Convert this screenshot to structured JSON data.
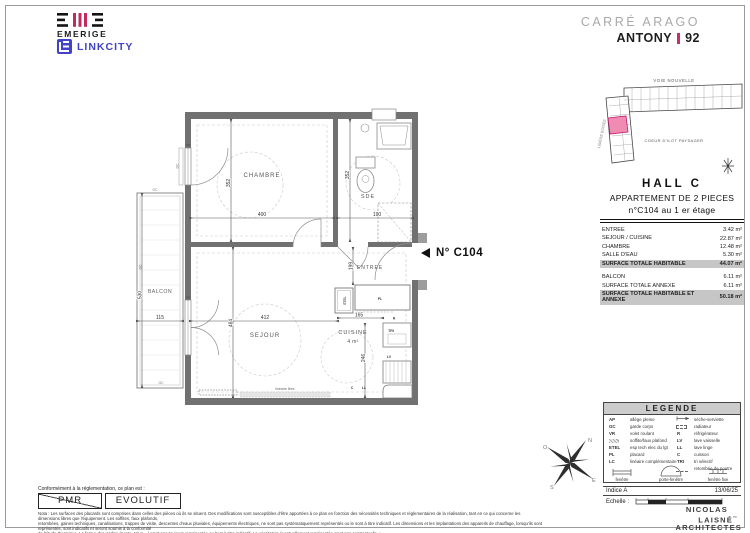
{
  "header": {
    "emerige": "EMERIGE",
    "linkcity": "LINKCITY",
    "project": "CARRÉ ARAGO",
    "city": "ANTONY",
    "dept": "92"
  },
  "sitemap": {
    "top_label": "VOIE NOUVELLE",
    "left_label": "LISIÈRE BOISÉE",
    "center_label": "COEUR D'ILOT PAYSAGER"
  },
  "unit_info": {
    "hall": "HALL  C",
    "type": "APPARTEMENT DE  2 PIECES",
    "number": "n°C104  au  1 er étage",
    "rows": [
      {
        "label": "ENTREE",
        "value": "3.42 m²"
      },
      {
        "label": "SEJOUR / CUISINE",
        "value": "22.87 m²"
      },
      {
        "label": "CHAMBRE",
        "value": "12.48 m²"
      },
      {
        "label": "SALLE D'EAU",
        "value": "5.30 m²"
      },
      {
        "label": "SURFACE TOTALE HABITABLE",
        "value": "44.07 m²"
      },
      {
        "label": "BALCON",
        "value": "6.11 m²"
      },
      {
        "label": "SURFACE TOTALE ANNEXE",
        "value": "6.11 m²"
      },
      {
        "label": "SURFACE TOTALE HABITABLE ET ANNEXE",
        "value": "50.18 m²"
      }
    ]
  },
  "plan": {
    "unit_marker": "N° C104",
    "rooms": {
      "chambre": "CHAMBRE",
      "sde": "SDE",
      "entree": "ENTREE",
      "sejour": "SEJOUR",
      "cuisine": "CUISINE",
      "cuisine_area": "4 m²",
      "balcon": "BALCON"
    },
    "dims": {
      "chambre_w": "400",
      "chambre_h": "352",
      "sde_w": "190",
      "sde_h": "352",
      "entree_h": "199",
      "sejour_w": "412",
      "sejour_h": "484",
      "balcon_w": "115",
      "balcon_h": "530",
      "cuisine_w": "165",
      "cuisine_h": "246"
    },
    "tags": {
      "pl": "PL",
      "etel": "ETEL",
      "tri": "TRI",
      "lv": "LV",
      "r": "R",
      "c": "C",
      "ll": "LL",
      "vr": "VR",
      "gc": "GC",
      "lineaire": "linéaire libre"
    }
  },
  "compass": {
    "n": "N",
    "e": "E",
    "s": "S",
    "o": "O"
  },
  "legend": {
    "title": "LEGENDE",
    "left": [
      {
        "abbr": "AP",
        "label": "allège pleine"
      },
      {
        "abbr": "GC",
        "label": "garde corps"
      },
      {
        "abbr": "VR",
        "label": "volet roulant"
      },
      {
        "abbr": "",
        "label": "soffite/faux plafond"
      },
      {
        "abbr": "ETEL",
        "label": "esp tech elec du lgt"
      },
      {
        "abbr": "PL",
        "label": "placard"
      },
      {
        "abbr": "LC",
        "label": "linéaire complémentaire"
      }
    ],
    "right": [
      {
        "abbr": "",
        "label": "sèche-serviette"
      },
      {
        "abbr": "",
        "label": "radiateur"
      },
      {
        "abbr": "R",
        "label": "réfrigérateur"
      },
      {
        "abbr": "LV",
        "label": "lave vaisselle"
      },
      {
        "abbr": "LL",
        "label": "lave linge"
      },
      {
        "abbr": "C",
        "label": "cuisson"
      },
      {
        "abbr": "TRI",
        "label": "tri sélectif"
      },
      {
        "abbr": "",
        "label": "retombée de poutre"
      }
    ],
    "windows": [
      "fenêtre",
      "porte-fenêtre",
      "fenêtre fixe"
    ]
  },
  "footer": {
    "conformity": "Conformément à la réglementation, ce plan est :",
    "pmr": "PMR",
    "evolutif": "EVOLUTIF",
    "indice_label": "Indice  A",
    "date": "13/06/25",
    "echelle_label": "Echelle :",
    "architect_l1": "NICOLAS",
    "architect_l2": "LAISNÉ",
    "architect_l3": "ARCHITECTES",
    "nota_lines": [
      "Nota : Les surfaces des placards sont comprises dans celles des pièces où ils se situent. Des modifications sont susceptibles d'être apportées à ce plan en fonction des nécessités techniques et réglementaires de la réalisation, tant en ce qui concerne les dimensions libres que l'équipement. Les soffites, faux plafonds,",
      "retombées, gaines techniques, canalisations, trappes de visite, descentes d'eaux pluviales, équipements électriques, ne sont pas systématiquement représentés ou le sont à titre indicatif. Les dimensions et les implantations des appareils de chauffage, lorsqu'ils sont représentés, sont indicatifs et seront soumis à la conformité",
      "de l'étude thermique. La forme des jardins (pente, talus ...) n'est pas toujours représentée ou l'est à titre indicatif. La végétation éventuellement représentée n'est pas contractuelle. »"
    ]
  }
}
